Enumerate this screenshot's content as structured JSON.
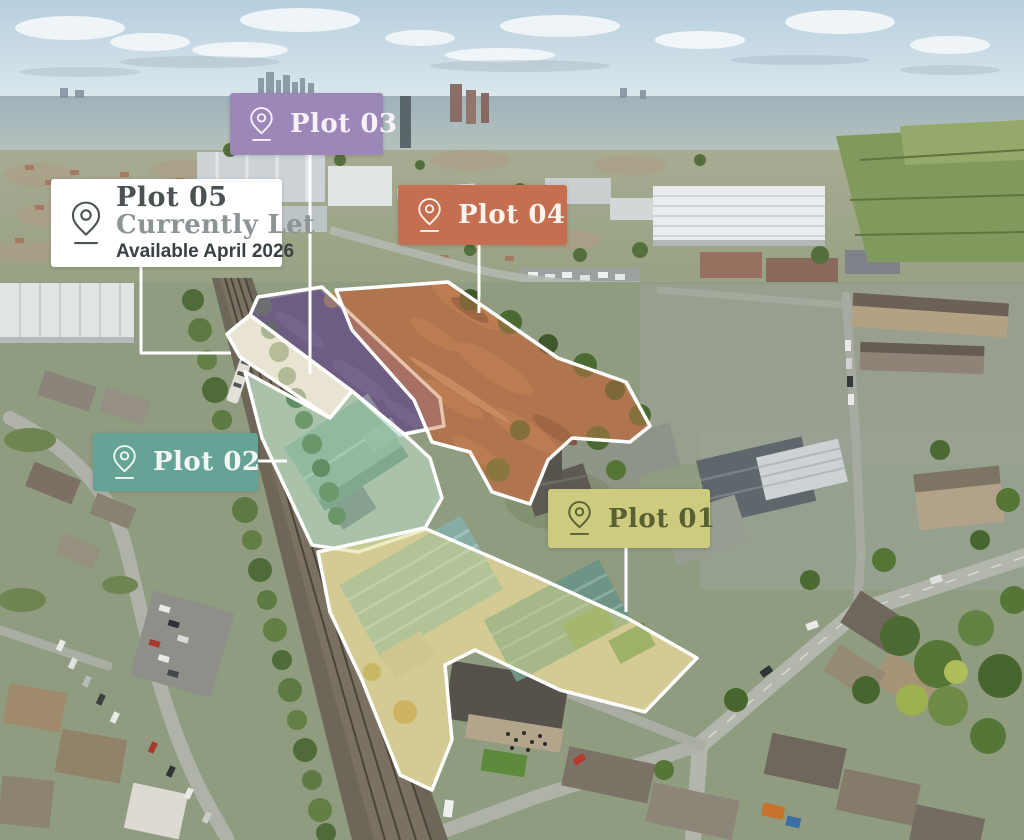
{
  "site_plan": {
    "outline_color": "#ffffff",
    "plots": [
      {
        "id": "plot-01",
        "label": "Plot 01",
        "chip_bg": "#cdcb7d",
        "chip_text": "#575f33",
        "overlay": "#ded98a"
      },
      {
        "id": "plot-02",
        "label": "Plot 02",
        "chip_bg": "#64a396",
        "chip_text": "#f2f7f4",
        "overlay": "#7fc0a8"
      },
      {
        "id": "plot-03",
        "label": "Plot 03",
        "chip_bg": "#9c87b8",
        "chip_text": "#f6f2f7",
        "overlay": "#7e62a2"
      },
      {
        "id": "plot-04",
        "label": "Plot 04",
        "chip_bg": "#c56e50",
        "chip_text": "#fbf3ee",
        "overlay": "#c97a4a"
      },
      {
        "id": "plot-05",
        "label": "Plot 05",
        "status": "Currently Let",
        "availability": "Available April 2026",
        "chip_bg": "#ffffff",
        "chip_text": "#4a5254",
        "status_color": "#8d9496",
        "availability_color": "#394145",
        "overlay": "#f6f1dd"
      }
    ]
  }
}
